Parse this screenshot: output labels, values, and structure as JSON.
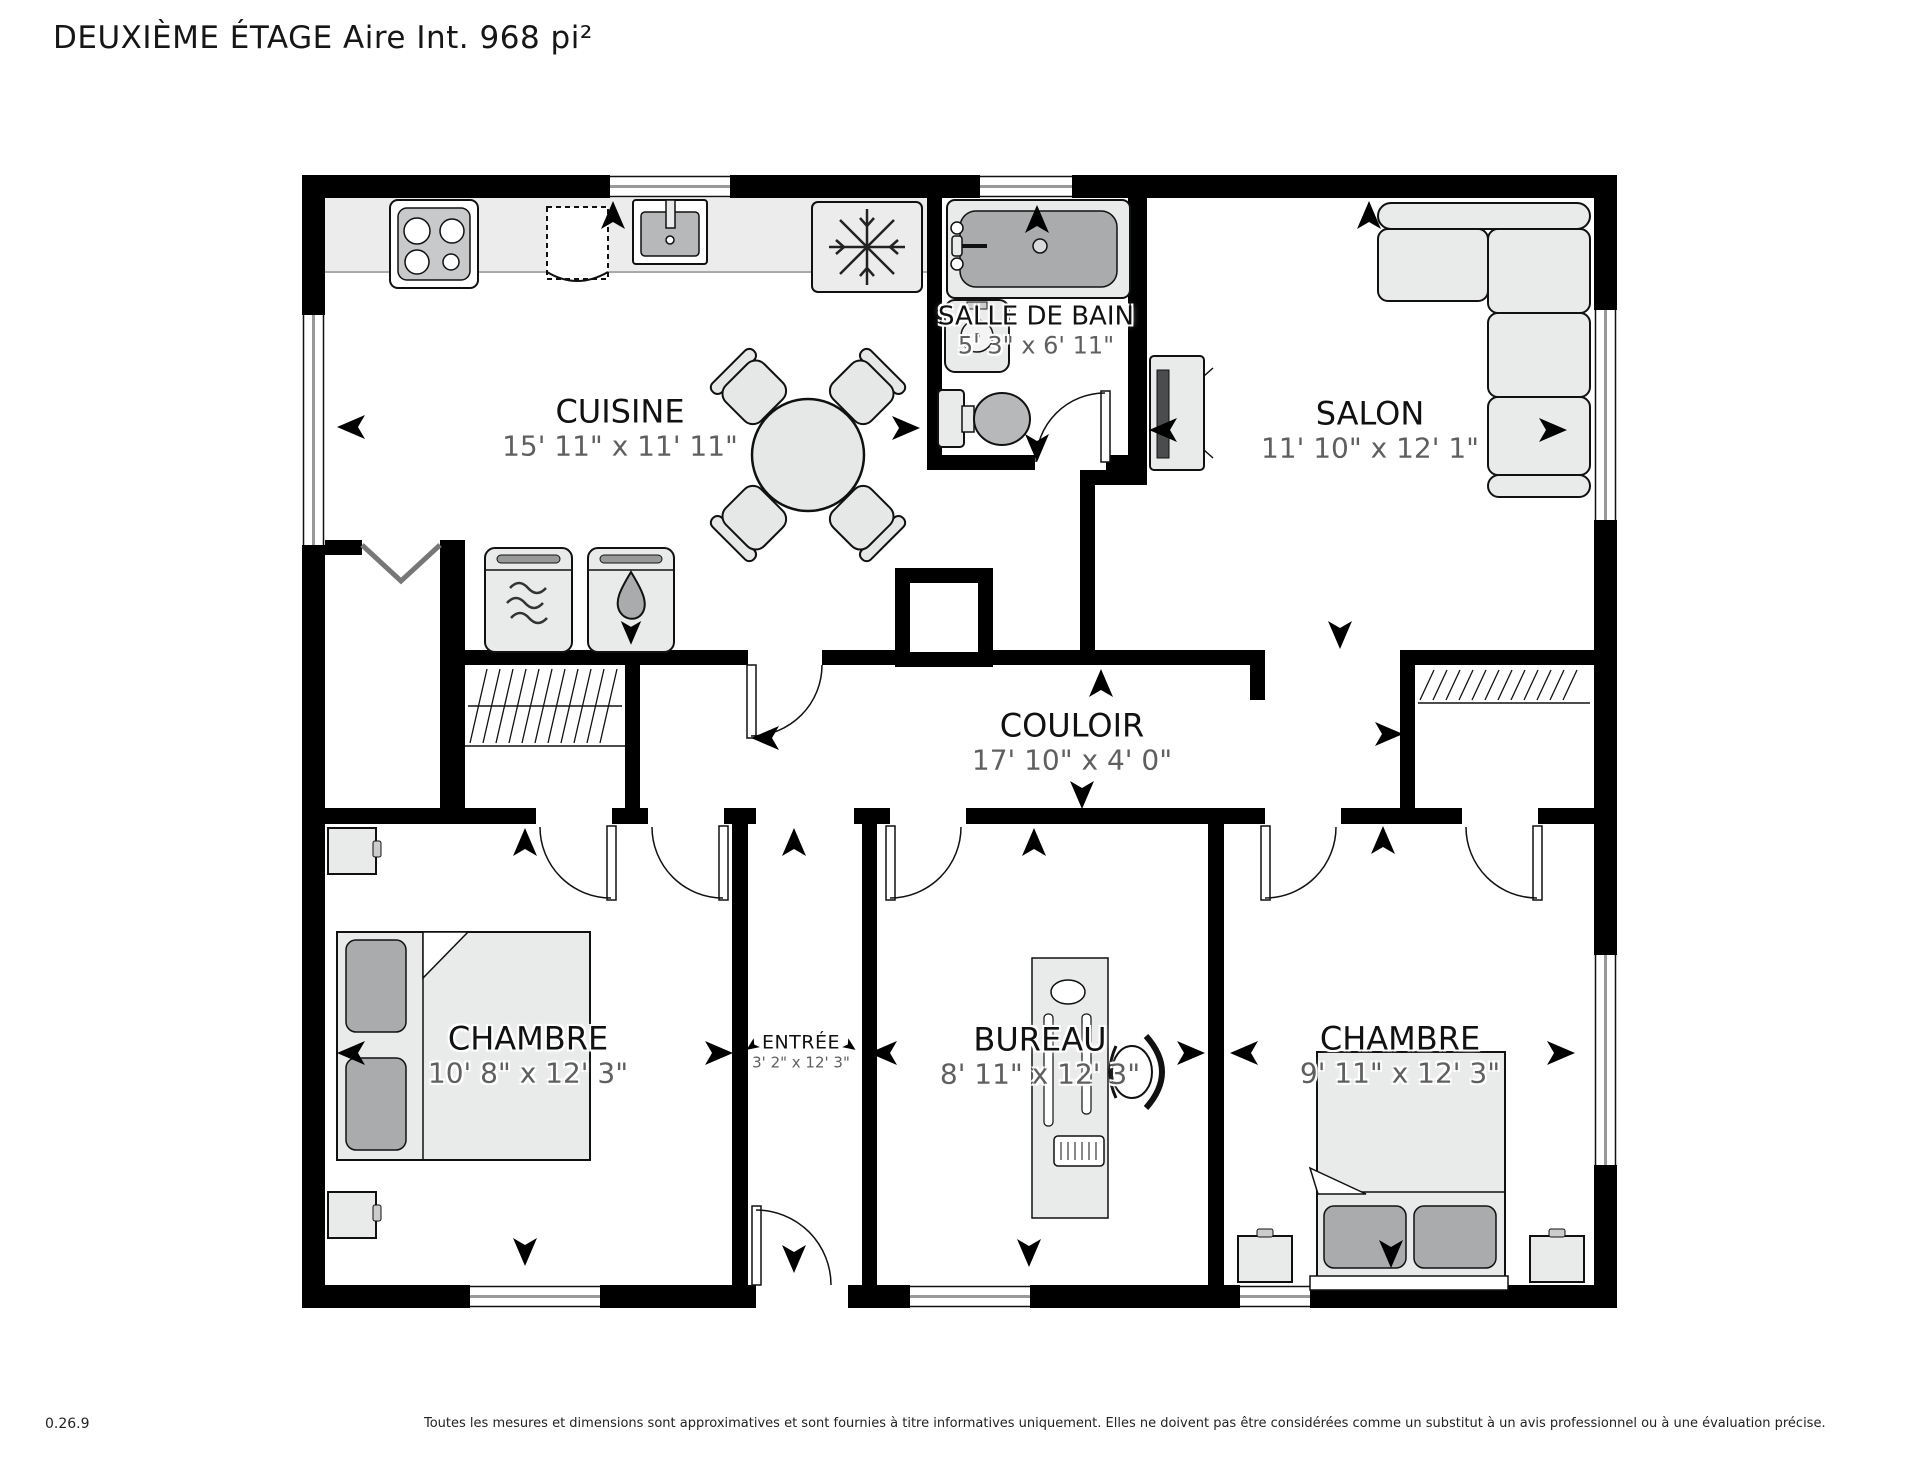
{
  "title": "DEUXIÈME ÉTAGE Aire Int. 968 pi²",
  "floorplan": {
    "rooms": [
      {
        "id": "cuisine",
        "name": "CUISINE",
        "dims": "15' 11\" x 11' 11\""
      },
      {
        "id": "salle-de-bain",
        "name": "SALLE DE BAIN",
        "dims": "5' 3\" x 6' 11\""
      },
      {
        "id": "salon",
        "name": "SALON",
        "dims": "11' 10\" x 12' 1\""
      },
      {
        "id": "couloir",
        "name": "COULOIR",
        "dims": "17' 10\" x 4' 0\""
      },
      {
        "id": "chambre-gauche",
        "name": "CHAMBRE",
        "dims": "10' 8\" x 12' 3\""
      },
      {
        "id": "entree",
        "name": "ENTRÉE",
        "dims": "3' 2\" x 12' 3\""
      },
      {
        "id": "bureau",
        "name": "BUREAU",
        "dims": "8' 11\" x 12' 3\""
      },
      {
        "id": "chambre-droite",
        "name": "CHAMBRE",
        "dims": "9' 11\" x 12' 3\""
      }
    ],
    "icons": {
      "stove-icon": "four-burner-cooktop",
      "dishwasher-icon": "dashed-appliance",
      "sink-icon": "kitchen-sink",
      "fridge-icon": "snowflake",
      "washer-icon": "waves",
      "dryer-icon": "water-drop",
      "bathtub-icon": "tub",
      "washbasin-icon": "round-basin",
      "toilet-icon": "toilet",
      "sofa-icon": "l-sectional-sofa",
      "tv-icon": "media-unit",
      "dining-icon": "round-table-4-chairs",
      "bed-icon": "double-bed",
      "desk-icon": "desk-with-chair",
      "closet-icon": "hanging-rod-hatch",
      "arrow-icon": "direction-chevron"
    },
    "colors": {
      "wall": "#000000",
      "furniture_fill": "#e9eaea",
      "accent_gray": "#a9abad",
      "counter": "#ececec",
      "room_name_text": "#111111",
      "dims_text": "#5f5f5f"
    }
  },
  "footer": {
    "version": "0.26.9",
    "disclaimer": "Toutes les mesures et dimensions sont approximatives et sont fournies à titre informatives uniquement. Elles ne doivent pas être considérées comme un substitut à un avis professionnel ou à une évaluation précise."
  }
}
